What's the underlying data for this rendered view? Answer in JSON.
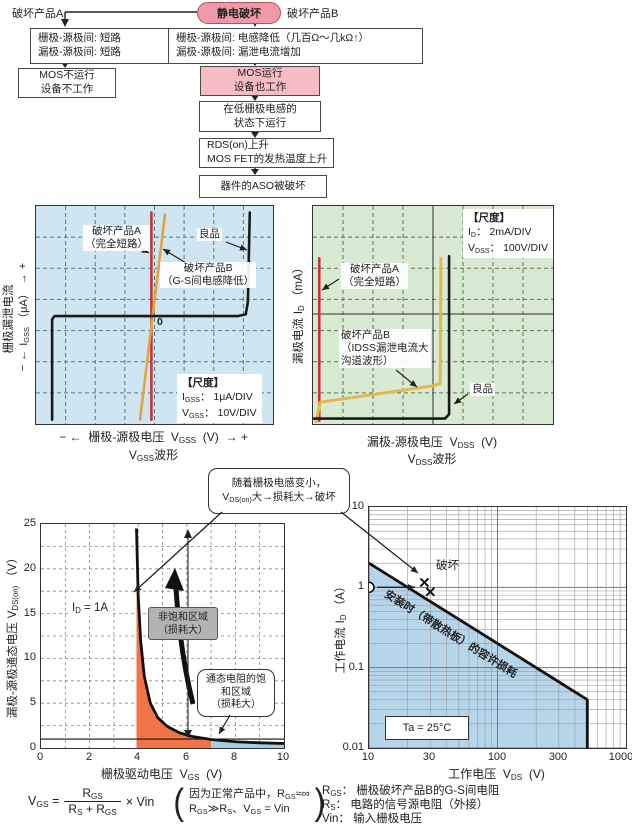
{
  "flow": {
    "esd": "静电破坏",
    "branch_a": "破坏产品A",
    "branch_b": "破坏产品B",
    "a1l1": "栅极-源极间: 短路",
    "a1l2": "漏极-源极间: 短路",
    "a2l1": "MOS不运行",
    "a2l2": "设备不工作",
    "b1l1": "栅极-源极间: 电感降低（几百Ω～几kΩ↑）",
    "b1l2": "漏极-源极间: 漏泄电流增加",
    "b2l1": "MOS运行",
    "b2l2": "设备也工作",
    "b3l1": "在低栅极电感的",
    "b3l2": "状态下运行",
    "b4l1": "RDS(on)上升",
    "b4l2": "MOS FET的发热温度上升",
    "b5": "器件的ASO被破坏"
  },
  "sl": {
    "ycn": "栅极漏泄电流",
    "ysym": "I",
    "ysub": "GSS",
    "yunit": "（μA）",
    "plus": "+",
    "minus": "−",
    "arrL": "←",
    "arrR": "→",
    "a1": "破坏产品A",
    "a2": "（完全短路）",
    "b1": "破坏产品B",
    "b2": "（G-S间电感降低）",
    "good": "良品",
    "zero": "0",
    "st": "【尺度】",
    "s1sym": "I",
    "s1sub": "GSS",
    "s1v": "： 1μA/DIV",
    "s2sym": "V",
    "s2sub": "GSS",
    "s2v": "： 10V/DIV",
    "xcn": "栅极-源极电压",
    "xsym": "V",
    "xsub": "GSS",
    "xunit": "(V)",
    "wsym": "V",
    "wsub": "GSS",
    "wrest": "波形"
  },
  "sr": {
    "ycn": "漏极电流",
    "ysym": "I",
    "ysub": "D",
    "yunit": "（mA）",
    "st": "【尺度】",
    "s1sym": "I",
    "s1sub": "D",
    "s1v": "： 2mA/DIV",
    "s2sym": "V",
    "s2sub": "DSS",
    "s2v": "： 100V/DIV",
    "a1": "破坏产品A",
    "a2": "（完全短路）",
    "b1": "破坏产品B",
    "b2": "（IDSS漏泄电流大",
    "b3": "沟道波形）",
    "good": "良品",
    "xcn": "漏极-源极电压",
    "xsym": "V",
    "xsub": "DSS",
    "xunit": "(V)",
    "wsym": "V",
    "wsub": "DSS",
    "wrest": "波形"
  },
  "bubble": {
    "l1": "随着栅极电感变小，",
    "sym": "V",
    "sub": "DS(on)",
    "rest": "大→损耗大→破坏"
  },
  "bl": {
    "ycn": "漏极-源极通态电压",
    "ysym": "V",
    "ysub": "DS(on)",
    "yunit": "（V）",
    "id_sym": "I",
    "id_sub": "D",
    "id_rest": " = 1A",
    "unsat1": "非饱和区域",
    "unsat2": "（损耗大）",
    "sat1": "通态电阻的饱",
    "sat2": "和区域",
    "sat3": "（损耗大）",
    "xcn": "栅极驱动电压",
    "xsym": "V",
    "xsub": "GS",
    "xunit": "(V)",
    "f_sym": "V",
    "f_sub": "GS",
    "f_eq": "=",
    "f_num": "R",
    "f_num_s": "GS",
    "f_d1": "R",
    "f_d1s": "S",
    "f_plus": "+",
    "f_d2": "R",
    "f_d2s": "GS",
    "f_mul": "× Vin",
    "n1a": "因为正常产品中，R",
    "n1s": "GS",
    "n1b": "≈∞",
    "n2a": "R",
    "n2as": "GS",
    "n2b": "≫R",
    "n2bs": "S",
    "n2c": "、V",
    "n2cs": "GS",
    "n2d": " = Vin"
  },
  "br": {
    "ycn": "工作电流",
    "ysym": "I",
    "ysub": "D",
    "yunit": "（A）",
    "brk": "破坏",
    "diag": "安装时（带散热板）的容许损耗",
    "ta": "Ta = 25°C",
    "xcn": "工作电压",
    "xsym": "V",
    "xsub": "DS",
    "xunit": "(V)",
    "leg1sym": "R",
    "leg1sub": "GS",
    "leg1": "： 栅极破坏产品B的G-S间电阻",
    "leg2sym": "R",
    "leg2sub": "S",
    "leg2": "： 电路的信号源电阻（外接）",
    "leg3sym": "Vin",
    "leg3": "： 输入栅极电压"
  },
  "chart_data": [
    {
      "type": "line",
      "name": "gate-leakage-scope",
      "title": "VGSS波形",
      "xlabel": "栅极-源极电压 VGSS (V)",
      "ylabel": "栅极漏泄电流 IGSS (μA)",
      "scale": {
        "IGSS": "1μA/DIV",
        "VGSS": "10V/DIV"
      },
      "grid": {
        "cols": 8,
        "rows": 7,
        "style": "dashed"
      },
      "bg": "#cfe5f2",
      "grid_color": "#54788c",
      "series": [
        {
          "name": "破坏产品A（完全短路）",
          "color": "#c93536",
          "w": 2.6,
          "points_norm": [
            [
              0.487,
              0.03
            ],
            [
              0.487,
              0.98
            ]
          ]
        },
        {
          "name": "破坏产品B（G-S间电感降低）",
          "color": "#e5a33c",
          "w": 2.6,
          "points_norm": [
            [
              0.544,
              0.04
            ],
            [
              0.439,
              0.98
            ]
          ]
        },
        {
          "name": "良品",
          "color": "#1a1a1a",
          "w": 2.6,
          "points_norm": [
            [
              0.068,
              0.98
            ],
            [
              0.068,
              0.52
            ],
            [
              0.078,
              0.505
            ],
            [
              0.85,
              0.505
            ],
            [
              0.885,
              0.497
            ],
            [
              0.894,
              0.44
            ],
            [
              0.902,
              0.03
            ]
          ]
        }
      ]
    },
    {
      "type": "line",
      "name": "drain-leakage-scope",
      "title": "VDSS波形",
      "xlabel": "漏极-源极电压 VDSS (V)",
      "ylabel": "漏极电流 ID (mA)",
      "scale": {
        "ID": "2mA/DIV",
        "VDSS": "100V/DIV"
      },
      "grid": {
        "cols": 8,
        "rows": 7,
        "style": "dashed"
      },
      "bg": "#d9ead2",
      "grid_color": "#5d7355",
      "series": [
        {
          "name": "破坏产品A（完全短路）",
          "color": "#c93536",
          "w": 2.6,
          "points_norm": [
            [
              0.026,
              0.24
            ],
            [
              0.026,
              0.985
            ]
          ]
        },
        {
          "name": "破坏产品B（IDSS漏泄电流大 沟道波形）",
          "color": "#e5b84b",
          "w": 3,
          "points_norm": [
            [
              0.013,
              0.99
            ],
            [
              0.03,
              0.9
            ],
            [
              0.2,
              0.873
            ],
            [
              0.5,
              0.825
            ],
            [
              0.53,
              0.815
            ],
            [
              0.533,
              0.24
            ]
          ]
        },
        {
          "name": "良品",
          "color": "#1a1a1a",
          "w": 2.6,
          "points_norm": [
            [
              0.004,
              0.975
            ],
            [
              0.55,
              0.975
            ],
            [
              0.567,
              0.955
            ],
            [
              0.567,
              0.23
            ]
          ]
        }
      ]
    },
    {
      "type": "line",
      "name": "vdson-vs-vgs",
      "xlabel": "栅极驱动电压 VGS (V)",
      "ylabel": "漏极-源极通态电压 VDS(on) (V)",
      "xlim": [
        0,
        10
      ],
      "ylim": [
        0,
        25
      ],
      "xticks": [
        0,
        2,
        4,
        6,
        8,
        10
      ],
      "yticks": [
        0,
        5,
        10,
        15,
        20,
        25
      ],
      "curve": [
        [
          3.93,
          24.5
        ],
        [
          4.0,
          17
        ],
        [
          4.1,
          12
        ],
        [
          4.25,
          8
        ],
        [
          4.5,
          5
        ],
        [
          4.8,
          3.4
        ],
        [
          5.2,
          2.4
        ],
        [
          5.7,
          1.7
        ],
        [
          6.2,
          1.3
        ],
        [
          7,
          0.95
        ],
        [
          8,
          0.7
        ],
        [
          9,
          0.58
        ],
        [
          10,
          0.5
        ]
      ],
      "hline": 1,
      "annotations": [
        "ID = 1A",
        "非饱和区域（损耗大）",
        "通态电阻的饱和区域（损耗大）"
      ],
      "regions": {
        "unsaturated_x": [
          3.93,
          7
        ],
        "saturated_x": [
          7,
          10
        ]
      },
      "colors": {
        "unsaturated": "#f07448",
        "saturated": "#a6cce4"
      }
    },
    {
      "type": "line",
      "name": "aso-working-area",
      "xlabel": "工作电压 VDS (V)",
      "ylabel": "工作电流 ID (A)",
      "xlim": [
        10,
        1000
      ],
      "ylim": [
        0.01,
        10
      ],
      "log": true,
      "xticks": [
        10,
        30,
        100,
        300,
        1000
      ],
      "yticks": [
        0.01,
        0.1,
        1,
        10
      ],
      "boundary": [
        [
          10,
          2
        ],
        [
          500,
          0.04
        ],
        [
          500,
          0.01
        ]
      ],
      "marker_circle": [
        10,
        1
      ],
      "marker_x": [
        [
          27,
          1.15
        ],
        [
          30,
          0.88
        ]
      ],
      "labels": {
        "break": "破坏",
        "diag": "安装时（带散热板）的容许损耗",
        "ta": "Ta = 25°C"
      },
      "region_color": "#b7d5e9"
    }
  ]
}
